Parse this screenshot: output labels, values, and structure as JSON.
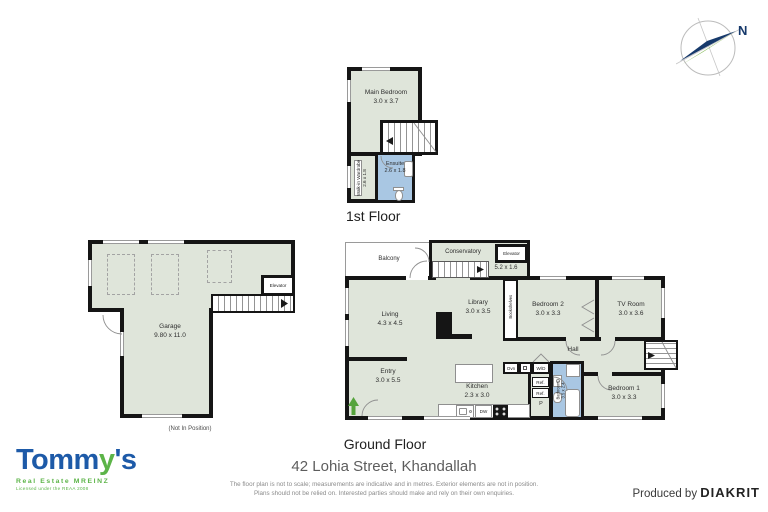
{
  "compass": {
    "north_label": "N"
  },
  "first_floor": {
    "title": "1st Floor",
    "main_bedroom": {
      "name": "Main Bedroom",
      "dims": "3.0 x 3.7"
    },
    "walk_in_wardrobe": {
      "name": "Walk-in Wardrobe",
      "dims": "2.6 x 1.8"
    },
    "ensuite": {
      "name": "Ensuite",
      "dims": "2.6 x 1.8"
    }
  },
  "garage_floor": {
    "garage": {
      "name": "Garage",
      "dims": "9.80 x 11.0"
    },
    "elevator": {
      "name": "Elevator"
    },
    "note": "(Not In Position)"
  },
  "ground_floor": {
    "title": "Ground Floor",
    "balcony": {
      "name": "Balcony"
    },
    "conservatory": {
      "name": "Conservatory",
      "dims": "5.2 x 1.6"
    },
    "elevator": {
      "name": "Elevator"
    },
    "living": {
      "name": "Living",
      "dims": "4.3 x 4.5"
    },
    "library": {
      "name": "Library",
      "dims": "3.0 x 3.5"
    },
    "bookshelves": {
      "name": "Bookshelves"
    },
    "bedroom2": {
      "name": "Bedroom 2",
      "dims": "3.0 x 3.3"
    },
    "tv_room": {
      "name": "TV Room",
      "dims": "3.0 x 3.6"
    },
    "hall": {
      "name": "Hall"
    },
    "entry": {
      "name": "Entry",
      "dims": "3.0 x 5.5"
    },
    "kitchen": {
      "name": "Kitchen",
      "dims": "2.3 x 3.0"
    },
    "bathroom": {
      "name": "Bathroom",
      "dims": "3.5 x 2.4"
    },
    "bedroom1": {
      "name": "Bedroom 1",
      "dims": "3.0 x 3.3"
    },
    "appliances": {
      "oven": "Ovn",
      "washer_dryer": "W/D",
      "fridge1": "Ref.",
      "fridge2": "Ref.",
      "pantry": "P",
      "dishwasher": "DW"
    }
  },
  "footer": {
    "address": "42 Lohia Street, Khandallah",
    "disclaimer_line1": "The floor plan is not to scale; measurements are indicative and in metres. Exterior elements are not in position.",
    "disclaimer_line2": "Plans should not be relied on. Interested parties should make and rely on their own enquiries.",
    "produced_by": "Produced by",
    "producer": "DIAKRIT"
  },
  "logo": {
    "part1": "Tomm",
    "part2": "y",
    "part3": "'s",
    "tagline": "Real Estate MREINZ",
    "license": "Licensed under the REAA 2008"
  },
  "colors": {
    "room_fill": "#dfe5da",
    "wet_room_fill": "#a9c7e3",
    "wall": "#151515",
    "brand_blue": "#1d5aa8",
    "brand_green": "#5cb448",
    "compass_navy": "#16396b"
  }
}
